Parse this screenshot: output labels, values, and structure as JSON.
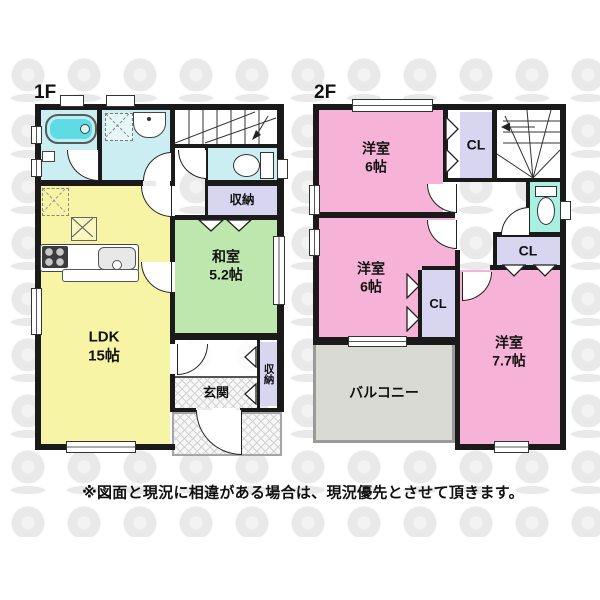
{
  "disclaimer": "※図面と現況に相違がある場合は、現況優先とさせて頂きます。",
  "floor1": {
    "label": "1F",
    "ldk": {
      "name": "LDK",
      "size": "15帖"
    },
    "washitsu": {
      "name": "和室",
      "size": "5.2帖"
    },
    "storage": "収納",
    "entrance": "玄関",
    "hall_storage": "収納"
  },
  "floor2": {
    "label": "2F",
    "bedroom_a": {
      "name": "洋室",
      "size": "6帖"
    },
    "bedroom_b": {
      "name": "洋室",
      "size": "6帖"
    },
    "bedroom_c": {
      "name": "洋室",
      "size": "7.7帖"
    },
    "closet_a": "CL",
    "closet_b": "CL",
    "closet_c": "CL",
    "balcony": "バルコニー"
  },
  "colors": {
    "ldk": "#F8F4A6",
    "washitsu": "#BDE7AC",
    "bedroom": "#F7B3D7",
    "wet_area": "#CBEEF3",
    "toilet_2f": "#A8F1E2",
    "closet": "#D8D5F1",
    "balcony": "#DADAD5",
    "wall": "#1a1a1a",
    "bathtub": "#5FDBE4"
  }
}
